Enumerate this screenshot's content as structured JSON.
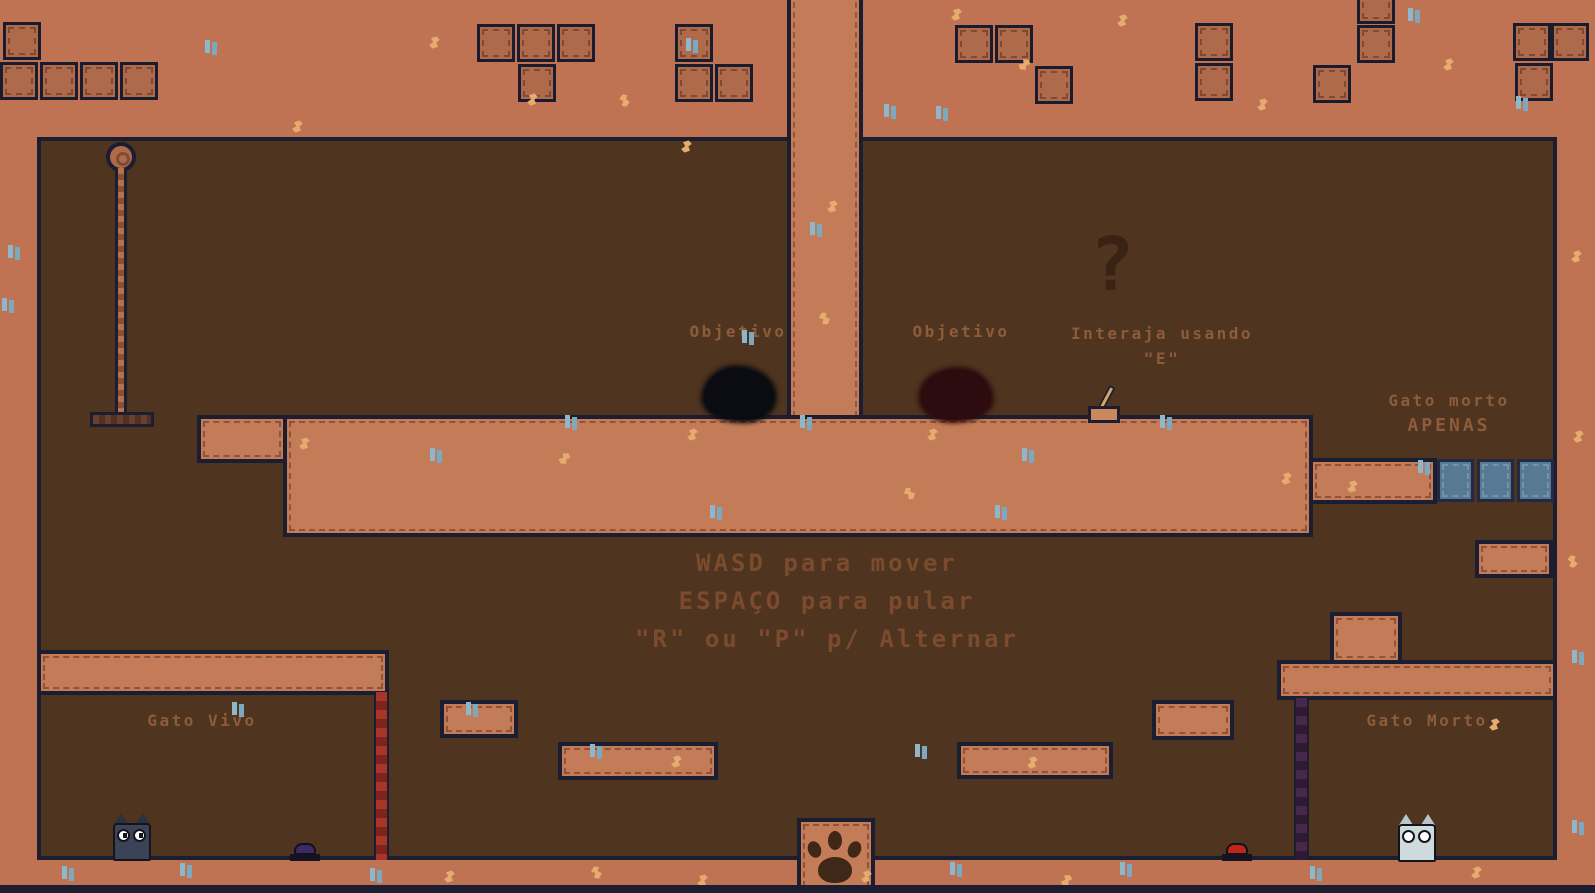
{
  "game": {
    "labels": {
      "objective_left": "Objetivo",
      "objective_right": "Objetivo",
      "interact_hint_line1": "Interaja usando",
      "interact_hint_line2": "\"E\"",
      "ghost_only_line1": "Gato morto",
      "ghost_only_line2": "APENAS",
      "controls_line1": "WASD para mover",
      "controls_line2": "ESPAÇO para pular",
      "controls_line3": "\"R\" ou \"P\" p/ Alternar",
      "zone_left": "Gato Vivo",
      "zone_right": "Gato Morto",
      "question_mark": "?"
    },
    "sprites": [
      "rope-anchor-icon",
      "rope-chain",
      "rope-platform",
      "objective-blob-dark",
      "objective-blob-red",
      "question-mark-icon",
      "lever",
      "ghost-tile",
      "live-cat-sprite",
      "ghost-cat-sprite",
      "button-blue",
      "button-red",
      "door-live-room",
      "door-dead-room",
      "paw-print-icon",
      "sparkle-decoration",
      "grass-tuft-decoration"
    ],
    "colors": {
      "wall": "#bf7352",
      "interior": "#4f341f",
      "platform": "#c37c57",
      "outline": "#1b1e31",
      "label_text": "#8d5c3a",
      "controls_text": "#7c4b2d",
      "ghost_tile": "#567a94",
      "door_live": "#a93528",
      "door_dead": "#46284a",
      "button_red": "#c0251a",
      "button_blue": "#3c2a66",
      "cat_live": "#3d4356",
      "cat_dead": "#cfdadd",
      "blob_dark": "#0b0c11",
      "blob_red": "#2d0b0e",
      "sparkle": "#e6ab6f",
      "tuft": "#8fb7cc"
    }
  }
}
